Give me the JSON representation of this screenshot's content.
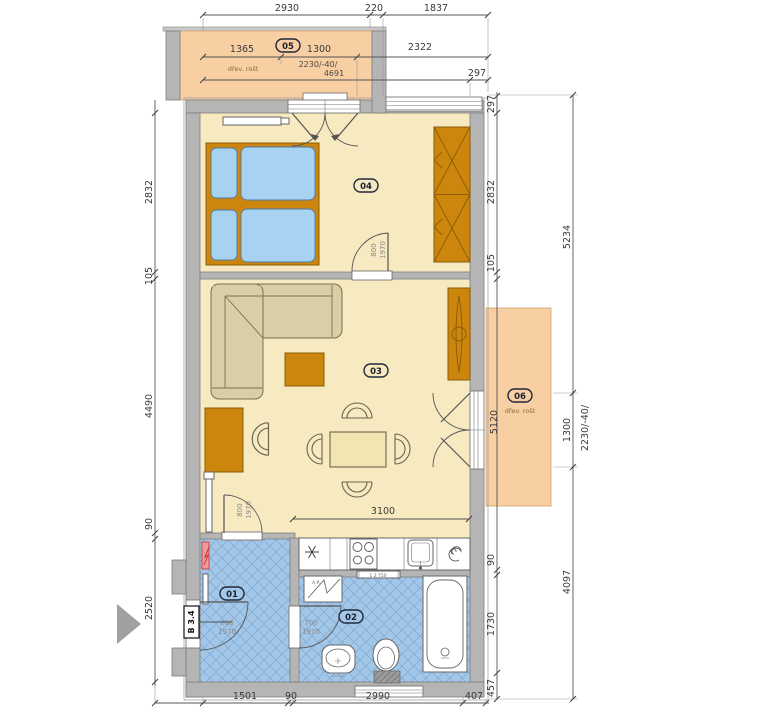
{
  "rooms": {
    "hall": {
      "number": "01"
    },
    "bathroom": {
      "number": "02"
    },
    "living": {
      "number": "03"
    },
    "bedroom": {
      "number": "04"
    },
    "balcony_top": {
      "number": "05",
      "surface": "dřev. rošt",
      "spec1": "2230/-40/",
      "spec2": "4691"
    },
    "balcony_right": {
      "number": "06",
      "surface": "dřev. rošt",
      "spec": "2230/-40/"
    }
  },
  "doors": {
    "entrance": {
      "w": "800",
      "h": "1970"
    },
    "living_hall": {
      "w": "800",
      "h": "1970"
    },
    "bedroom": {
      "w": "800",
      "h": "1970"
    },
    "bathroom": {
      "w": "700",
      "h": "1970"
    }
  },
  "marks": {
    "section": "B 3.4",
    "washer": "A.P.",
    "rail": "1 2 750"
  },
  "dims": {
    "top1": [
      "2930",
      "220",
      "1837"
    ],
    "top2": [
      "1365",
      "1300",
      "2322"
    ],
    "top3": [
      "297"
    ],
    "left": [
      "2832",
      "105",
      "4490",
      "90",
      "2520"
    ],
    "right_inner": [
      "297",
      "2832",
      "105",
      "5120",
      "90",
      "1730",
      "457"
    ],
    "right_outer": [
      "5234",
      "1300",
      "4097"
    ],
    "right_outer_spec": "2230/-40/",
    "bottom": [
      "1501",
      "90",
      "2990",
      "407"
    ],
    "living_3100": "3100"
  },
  "colors": {
    "wall": "#b5b5b5",
    "floor": "#f7eac0",
    "balcony": "#f7cfa2",
    "tile": "#a3c7e8",
    "wood": "#cc860d",
    "sofa": "#d8cfa6",
    "mattress": "#a8d2f2",
    "panel_red": "#ef9a9a"
  }
}
